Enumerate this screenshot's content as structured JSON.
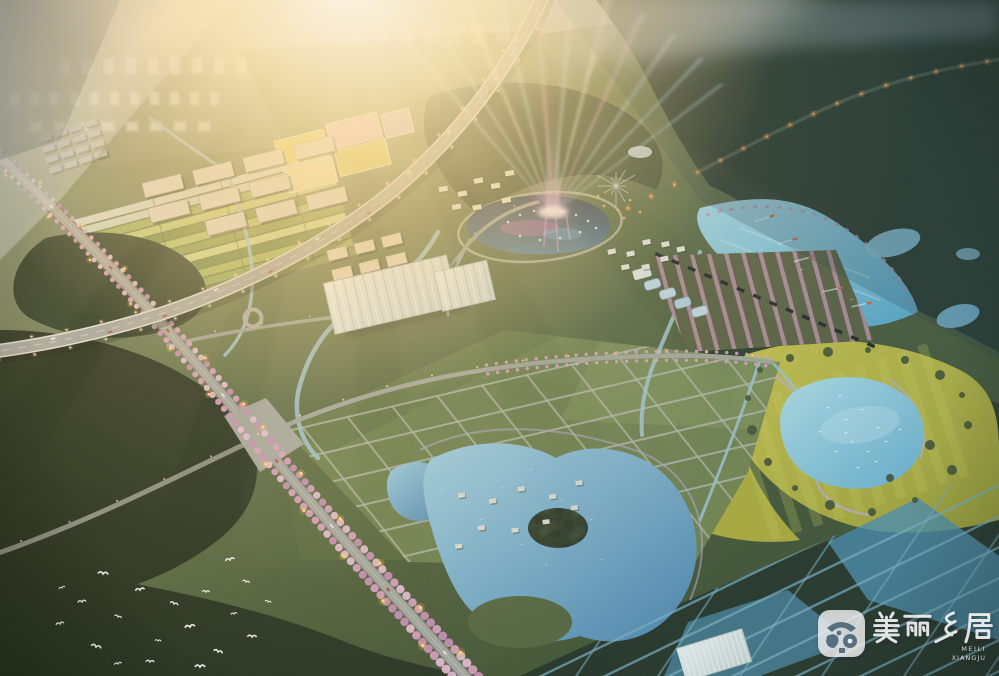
{
  "watermark": {
    "title": "美丽乡居",
    "pinyin_line1": "MEILI",
    "pinyin_line2": "XIANGJU",
    "logo": "meili-xiangju-badge"
  },
  "palette": {
    "sun_flare": "#ffe9b4",
    "warm_tint": "#ffcf8a",
    "haze_blue": "#dfe7ee",
    "forest_dark": "#2b3622",
    "meadow_green": "#6d7c45",
    "rapeseed_yellow": "#c6bf3e",
    "lake_cyan": "#7cc0d6",
    "pond_blue": "#74acd0",
    "blossom_pink": "#e2a2c4",
    "road_grey": "#a8a8a0",
    "beam_cyan": "#b8e2ff",
    "beam_magenta": "#f2a8e6",
    "street_light": "#ffd890",
    "boat_orange": "#cf6434"
  }
}
